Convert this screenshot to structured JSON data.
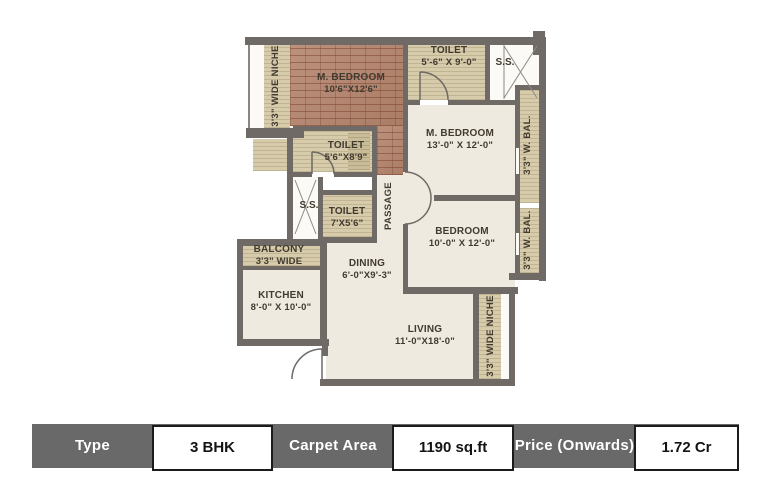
{
  "plan": {
    "niche_left": "3'3\" WIDE NICHE",
    "m_bedroom_1": {
      "name": "M. BEDROOM",
      "dims": "10'6\"X12'6\""
    },
    "toilet_top": {
      "name": "TOILET",
      "dims": "5'-6\" X 9'-0\""
    },
    "ss_top": "S.S.",
    "m_bedroom_2": {
      "name": "M. BEDROOM",
      "dims": "13'-0\" X 12'-0\""
    },
    "w_bal_top": "3'3\" W. BAL.",
    "toilet_mid": {
      "name": "TOILET",
      "dims": "5'6\"X8'9\""
    },
    "ss_left": "S.S.",
    "toilet_small": {
      "name": "TOILET",
      "dims": "7'X5'6\""
    },
    "passage": "PASSAGE",
    "bedroom": {
      "name": "BEDROOM",
      "dims": "10'-0\" X 12'-0\""
    },
    "w_bal_bottom": "3'3\" W. BAL.",
    "balcony": {
      "name": "BALCONY",
      "dims": "3'3\" WIDE"
    },
    "kitchen": {
      "name": "KITCHEN",
      "dims": "8'-0\" X 10'-0\""
    },
    "dining": {
      "name": "DINING",
      "dims": "6'-0\"X9'-3\""
    },
    "living": {
      "name": "LIVING",
      "dims": "11'-0\"X18'-0\""
    },
    "niche_bottom": "3'3\" WIDE NICHE"
  },
  "table": {
    "type_label": "Type",
    "type_value": "3 BHK",
    "carpet_label": "Carpet Area",
    "carpet_value": "1190 sq.ft",
    "price_label": "Price (Onwards)",
    "price_value": "1.72 Cr"
  },
  "colors": {
    "wall": "#6f6a65",
    "brick_floor": "#b3836b",
    "deck_beige": "#d6cbab",
    "room_cream": "#efeadf",
    "table_gray": "#696969"
  }
}
